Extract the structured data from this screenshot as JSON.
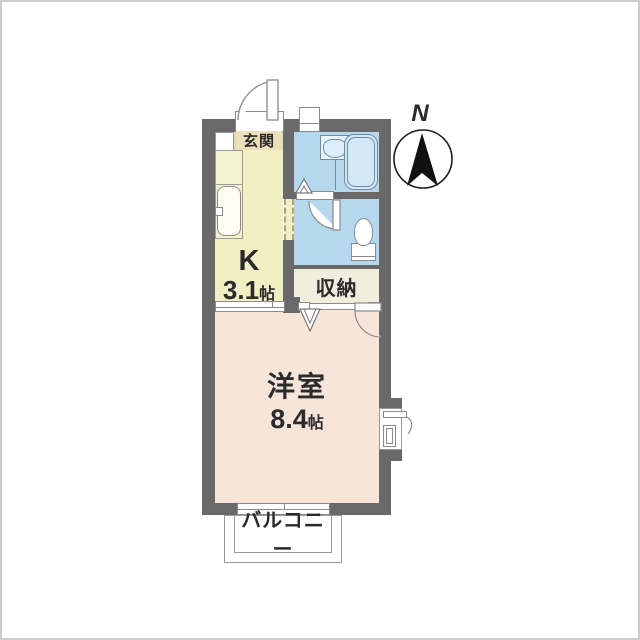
{
  "compass": {
    "north_label": "N"
  },
  "rooms": {
    "genkan": {
      "label": "玄関"
    },
    "kitchen": {
      "label": "K",
      "size": "3.1",
      "unit": "帖"
    },
    "bathroom": {
      "name": "bathroom"
    },
    "toilet": {
      "name": "toilet"
    },
    "storage": {
      "label": "収納"
    },
    "western": {
      "label": "洋室",
      "size": "8.4",
      "unit": "帖"
    },
    "balcony": {
      "label": "バルコニー"
    }
  },
  "icons": {
    "compass": "north-arrow-icon",
    "bathtub": "bathtub-icon",
    "washbasin": "washbasin-icon",
    "toilet": "toilet-icon",
    "kitchen_sink": "kitchen-sink-icon",
    "entry_door": "entry-door-swing-icon",
    "sliding_door": "sliding-door-icon",
    "window": "window-icon"
  },
  "colors": {
    "wall": "#696969",
    "kitchen": "#f1efc3",
    "genkan": "#e4d6ae",
    "wet": "#b5d8ee",
    "room": "#f8e5da",
    "storage": "#f3eddd",
    "line": "#8a8a8a"
  }
}
